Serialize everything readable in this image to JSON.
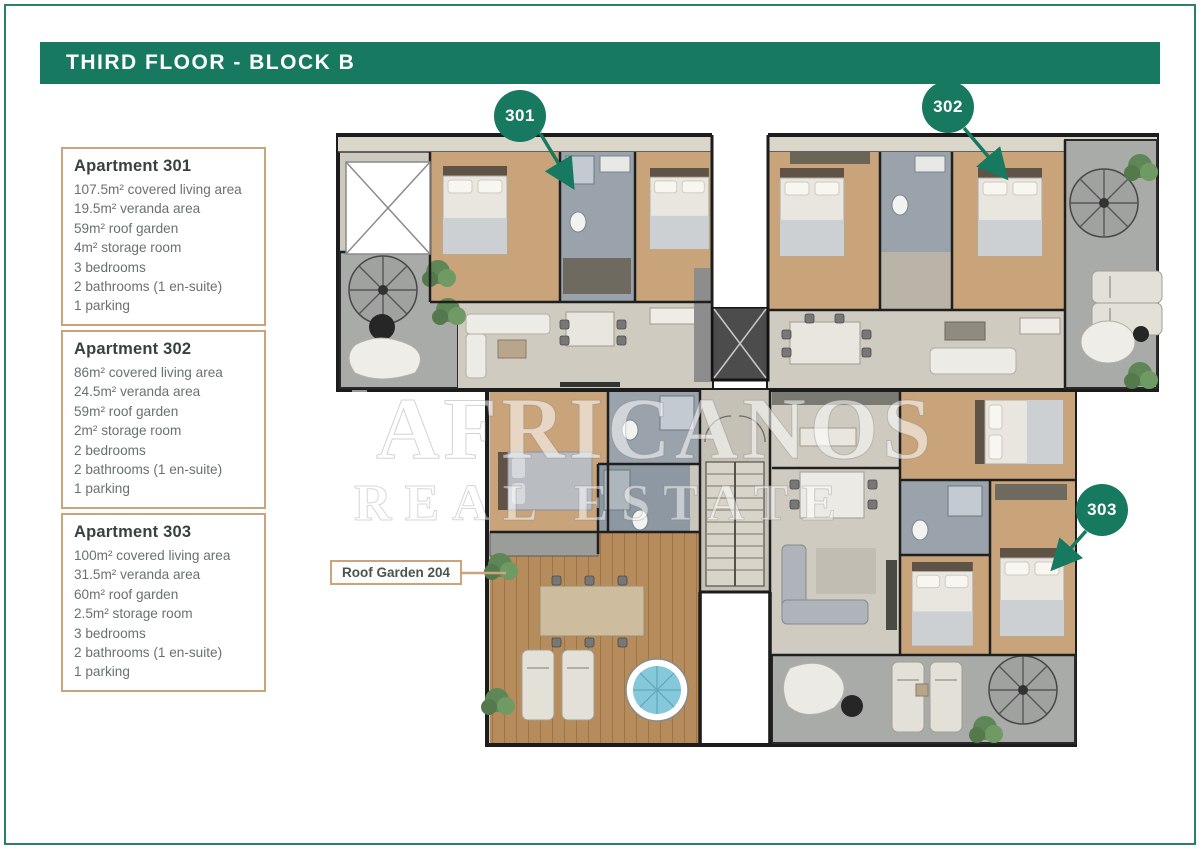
{
  "header": {
    "title": "THIRD FLOOR - BLOCK B"
  },
  "apartments": [
    {
      "name": "Apartment 301",
      "details": [
        "107.5m² covered living area",
        "19.5m² veranda area",
        "59m² roof garden",
        "4m² storage room",
        "3 bedrooms",
        "2 bathrooms (1 en-suite)",
        "1 parking"
      ]
    },
    {
      "name": "Apartment 302",
      "details": [
        "86m² covered living area",
        "24.5m² veranda area",
        "59m² roof garden",
        "2m² storage room",
        "2 bedrooms",
        "2 bathrooms (1 en-suite)",
        "1 parking"
      ]
    },
    {
      "name": "Apartment 303",
      "details": [
        "100m² covered living area",
        "31.5m² veranda area",
        "60m² roof garden",
        "2.5m² storage room",
        "3 bedrooms",
        "2 bathrooms (1 en-suite)",
        "1 parking"
      ]
    }
  ],
  "plan": {
    "unit_badges": [
      {
        "label": "301"
      },
      {
        "label": "302"
      },
      {
        "label": "303"
      }
    ],
    "roof_garden_label": "Roof Garden 204",
    "watermark": {
      "line1": "AFRICANOS",
      "line2": "REAL ESTATE"
    }
  },
  "colors": {
    "brand_green": "#17795f",
    "tan_border": "#c9a47c",
    "wall": "#1c1c1c",
    "wood_floor": "#c9a47b",
    "deck_wood": "#b78c5c",
    "terrace_gray": "#a8aba8",
    "bath_gray_blue": "#9aa3ac",
    "pool_blue": "#85c8d9"
  }
}
